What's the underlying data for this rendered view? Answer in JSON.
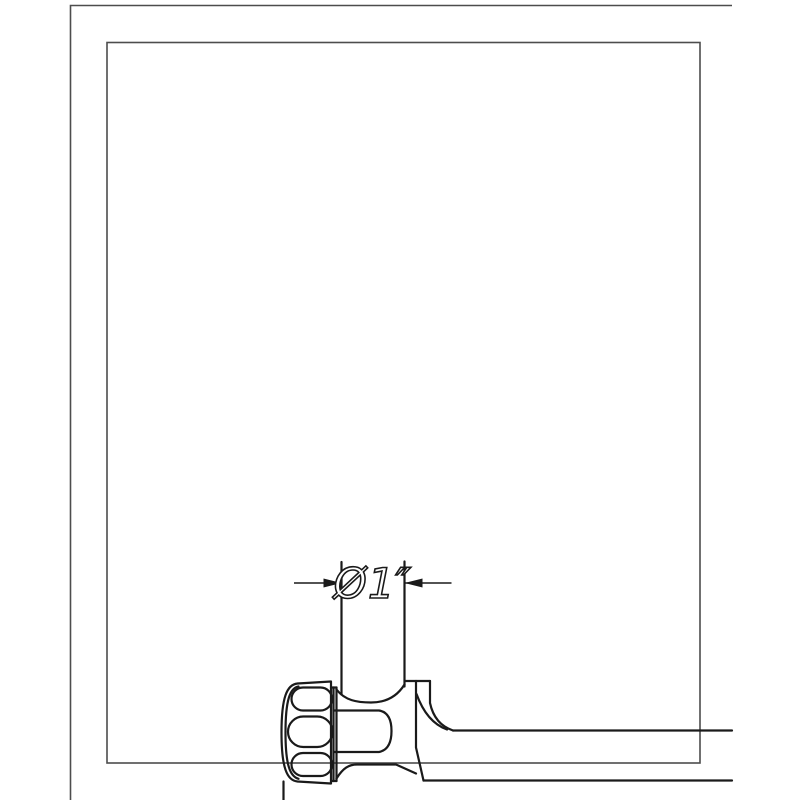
{
  "drawing": {
    "title": "wall-mounted rail clamp detail",
    "dimension_label": "Ø1″",
    "colors": {
      "background": "#ffffff",
      "construction_line": "#4d4d4d",
      "object_line": "#1a1a1a",
      "dimension_line": "#1a1a1a",
      "dimension_text_fill": "#ffffff"
    }
  }
}
